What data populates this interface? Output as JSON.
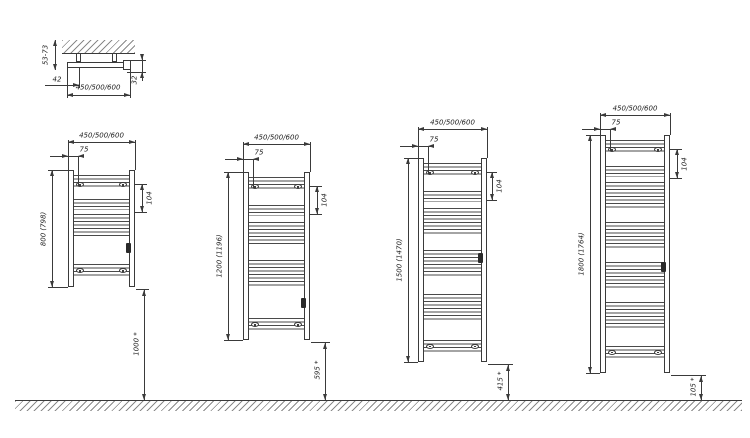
{
  "detail_view": {
    "wall_distance_label": "53-73",
    "offset_label": "42",
    "depth_label": "32",
    "width_label": "450/500/600"
  },
  "radiators": [
    {
      "name": "radiator-800",
      "width_label": "450/500/600",
      "bracket_offset_label": "75",
      "top_section_label": "104",
      "height_label": "800 (798)",
      "floor_clearance_label": "1000 *"
    },
    {
      "name": "radiator-1200",
      "width_label": "450/500/600",
      "bracket_offset_label": "75",
      "top_section_label": "104",
      "height_label": "1200 (1196)",
      "floor_clearance_label": "595 *"
    },
    {
      "name": "radiator-1500",
      "width_label": "450/500/600",
      "bracket_offset_label": "75",
      "top_section_label": "104",
      "height_label": "1500 (1470)",
      "floor_clearance_label": "415 *"
    },
    {
      "name": "radiator-1800",
      "width_label": "450/500/600",
      "bracket_offset_label": "75",
      "top_section_label": "104",
      "height_label": "1800 (1764)",
      "floor_clearance_label": "105 *"
    }
  ],
  "colors": {
    "line": "#3a3a3a",
    "background": "#ffffff"
  }
}
